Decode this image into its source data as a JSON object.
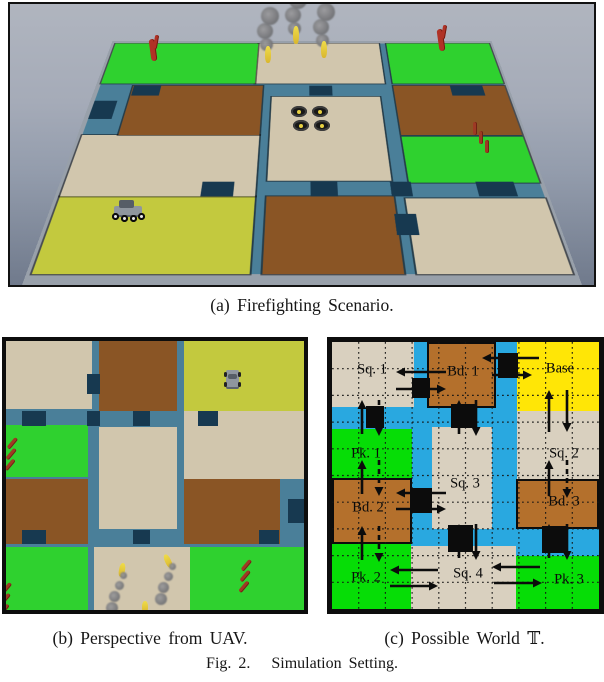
{
  "captions": {
    "a": "(a) Firefighting Scenario.",
    "b": "(b) Perspective from UAV.",
    "c": "(c) Possible World 𝕋.",
    "fig": "Fig. 2.   Simulation Setting."
  },
  "palette": {
    "tan": "#d1c6ad",
    "brown": "#8a5525",
    "green": "#2fd12f",
    "yellow": "#c3c93e",
    "road": "#4a7f99",
    "roadDark": "#173950",
    "groundGray": "#98a0aa",
    "mapBlue": "#29a8e0",
    "mapTan": "#d9d0bf",
    "mapBrown": "#b4702c",
    "mapGreen": "#06dd06",
    "mapYellow": "#ffe606",
    "ink": "#0c0c0c"
  },
  "world": {
    "tiles": [
      {
        "name": "square-1",
        "c": "tan",
        "x": 0,
        "y": 0,
        "w": 28.7,
        "h": 25.2
      },
      {
        "name": "building-1",
        "c": "brown",
        "x": 31.2,
        "y": 0,
        "w": 26.2,
        "h": 26
      },
      {
        "name": "base",
        "c": "yellow",
        "x": 59.7,
        "y": 0,
        "w": 40.3,
        "h": 26
      },
      {
        "name": "park-1",
        "c": "green",
        "x": 0,
        "y": 31.2,
        "w": 27.5,
        "h": 19.3
      },
      {
        "name": "square-2",
        "c": "tan",
        "x": 59.7,
        "y": 26,
        "w": 40.3,
        "h": 25.3
      },
      {
        "name": "square-3",
        "c": "tan",
        "x": 31.2,
        "y": 31.9,
        "w": 26.2,
        "h": 37.9
      },
      {
        "name": "building-2",
        "c": "brown",
        "x": 0,
        "y": 51.3,
        "w": 27.5,
        "h": 24.2
      },
      {
        "name": "building-3",
        "c": "brown",
        "x": 59.7,
        "y": 51.3,
        "w": 32.2,
        "h": 24.2
      },
      {
        "name": "park-2",
        "c": "green",
        "x": 0,
        "y": 76.6,
        "w": 27.5,
        "h": 23.4
      },
      {
        "name": "square-4",
        "c": "tan",
        "x": 29.5,
        "y": 76.6,
        "w": 32.2,
        "h": 23.4
      },
      {
        "name": "park-3",
        "c": "green",
        "x": 61.7,
        "y": 76.6,
        "w": 38.3,
        "h": 23.4
      }
    ],
    "road_patches": [
      {
        "x": 5.4,
        "y": 26.0,
        "w": 8.1,
        "h": 5.6
      },
      {
        "x": 27.2,
        "y": 26.0,
        "w": 4.4,
        "h": 5.6
      },
      {
        "x": 42.6,
        "y": 26.0,
        "w": 5.7,
        "h": 5.6
      },
      {
        "x": 64.4,
        "y": 26.0,
        "w": 6.7,
        "h": 5.6
      },
      {
        "x": 27.2,
        "y": 12.3,
        "w": 4.4,
        "h": 7.4
      },
      {
        "x": 5.4,
        "y": 70.3,
        "w": 8.1,
        "h": 5.2
      },
      {
        "x": 42.6,
        "y": 70.3,
        "w": 5.7,
        "h": 5.2
      },
      {
        "x": 84.9,
        "y": 70.3,
        "w": 6.7,
        "h": 5.2
      },
      {
        "x": 94.6,
        "y": 58.7,
        "w": 5.4,
        "h": 8.9
      }
    ]
  },
  "panel_a": {
    "sprites": [
      {
        "t": "smokeplume",
        "x": 247,
        "y": 6
      },
      {
        "t": "smokeplume",
        "x": 275,
        "y": -10
      },
      {
        "t": "smokeplume",
        "x": 303,
        "y": 2
      },
      {
        "t": "flame",
        "x": 255,
        "y": 42,
        "h": 17,
        "r": 0
      },
      {
        "t": "flame",
        "x": 283,
        "y": 22,
        "h": 18,
        "r": 0
      },
      {
        "t": "flame",
        "x": 311,
        "y": 37,
        "h": 17,
        "r": 0
      },
      {
        "t": "fireflame",
        "x": 140,
        "y": 31
      },
      {
        "t": "fireflame",
        "x": 428,
        "y": 21
      },
      {
        "t": "firesticks",
        "x": 463,
        "y": 118,
        "r": 0
      },
      {
        "t": "drone",
        "x": 281,
        "y": 102
      },
      {
        "t": "rover3d",
        "x": 102,
        "y": 196
      }
    ]
  },
  "panel_b": {
    "sprites": [
      {
        "t": "rovertop",
        "x": 218,
        "y": 29
      },
      {
        "t": "firesticks",
        "x": 9,
        "y": 96,
        "r": 40
      },
      {
        "t": "firesticks",
        "x": 3,
        "y": 241,
        "r": 40
      },
      {
        "t": "firesticks",
        "x": 243,
        "y": 218,
        "r": 40
      },
      {
        "t": "flame",
        "x": 113,
        "y": 222,
        "h": 14,
        "r": 10
      },
      {
        "t": "flame",
        "x": 159,
        "y": 213,
        "h": 14,
        "r": -25
      },
      {
        "t": "flame",
        "x": 136,
        "y": 260,
        "h": 12,
        "r": 0
      },
      {
        "t": "smoketrail",
        "x": 101,
        "y": 231
      },
      {
        "t": "smoketrail",
        "x": 150,
        "y": 222
      }
    ]
  },
  "panel_c": {
    "grid_cell": 26.7,
    "regions": [
      {
        "id": "sq1",
        "label": "Sq. 1",
        "c": "mapTan",
        "x": 0,
        "y": 0,
        "w": 82,
        "h": 65,
        "outlined": false,
        "lx": 40,
        "ly": 28
      },
      {
        "id": "bd1",
        "label": "Bd. 1",
        "c": "mapBrown",
        "x": 95,
        "y": 0,
        "w": 69,
        "h": 66,
        "outlined": true,
        "lx": 131,
        "ly": 30
      },
      {
        "id": "base",
        "label": "Base",
        "c": "mapYellow",
        "x": 185,
        "y": 0,
        "w": 82,
        "h": 69,
        "outlined": false,
        "lx": 228,
        "ly": 27
      },
      {
        "id": "pk1",
        "label": "Pk. 1",
        "c": "mapGreen",
        "x": 0,
        "y": 87,
        "w": 80,
        "h": 49,
        "outlined": false,
        "lx": 34,
        "ly": 112
      },
      {
        "id": "sq2",
        "label": "Sq. 2",
        "c": "mapTan",
        "x": 185,
        "y": 69,
        "w": 82,
        "h": 68,
        "outlined": false,
        "lx": 232,
        "ly": 112
      },
      {
        "id": "sq3",
        "label": "Sq. 3",
        "c": "mapTan",
        "x": 100,
        "y": 85,
        "w": 60,
        "h": 102,
        "outlined": false,
        "lx": 133,
        "ly": 142
      },
      {
        "id": "bd2",
        "label": "Bd. 2",
        "c": "mapBrown",
        "x": 0,
        "y": 136,
        "w": 80,
        "h": 66,
        "outlined": true,
        "lx": 36,
        "ly": 166
      },
      {
        "id": "bd3",
        "label": "Bd. 3",
        "c": "mapBrown",
        "x": 184,
        "y": 137,
        "w": 83,
        "h": 50,
        "outlined": true,
        "lx": 232,
        "ly": 160
      },
      {
        "id": "pk2",
        "label": "Pk. 2",
        "c": "mapGreen",
        "x": 0,
        "y": 202,
        "w": 79,
        "h": 65,
        "outlined": false,
        "lx": 34,
        "ly": 236
      },
      {
        "id": "sq4",
        "label": "Sq. 4",
        "c": "mapTan",
        "x": 79,
        "y": 204,
        "w": 105,
        "h": 63,
        "outlined": false,
        "lx": 136,
        "ly": 232
      },
      {
        "id": "pk3",
        "label": "Pk. 3",
        "c": "mapGreen",
        "x": 184,
        "y": 214,
        "w": 83,
        "h": 53,
        "outlined": false,
        "lx": 237,
        "ly": 238
      }
    ],
    "doors": [
      [
        80,
        36,
        18,
        20
      ],
      [
        34,
        64,
        18,
        22
      ],
      [
        166,
        11,
        20,
        25
      ],
      [
        119,
        62,
        25,
        24
      ],
      [
        78,
        146,
        22,
        25
      ],
      [
        116,
        183,
        25,
        27
      ],
      [
        210,
        184,
        25,
        27
      ]
    ],
    "arrows": [
      [
        114,
        30,
        64,
        30,
        0
      ],
      [
        64,
        47,
        114,
        47,
        0
      ],
      [
        207,
        16,
        150,
        16,
        0
      ],
      [
        160,
        33,
        200,
        33,
        0
      ],
      [
        114,
        151,
        64,
        151,
        0
      ],
      [
        64,
        167,
        114,
        167,
        0
      ],
      [
        106,
        228,
        58,
        228,
        0
      ],
      [
        58,
        244,
        106,
        244,
        0
      ],
      [
        208,
        225,
        160,
        225,
        0
      ],
      [
        162,
        241,
        210,
        241,
        0
      ],
      [
        30,
        92,
        30,
        58,
        0
      ],
      [
        47,
        58,
        47,
        94,
        1
      ],
      [
        30,
        152,
        30,
        118,
        0
      ],
      [
        47,
        118,
        47,
        154,
        1
      ],
      [
        30,
        218,
        30,
        184,
        0
      ],
      [
        47,
        184,
        47,
        220,
        1
      ],
      [
        217,
        90,
        217,
        48,
        0
      ],
      [
        235,
        48,
        235,
        90,
        0
      ],
      [
        217,
        154,
        217,
        118,
        0
      ],
      [
        235,
        118,
        235,
        156,
        1
      ],
      [
        127,
        92,
        127,
        58,
        0
      ],
      [
        144,
        58,
        144,
        94,
        0
      ],
      [
        127,
        216,
        127,
        182,
        0
      ],
      [
        144,
        182,
        144,
        218,
        0
      ],
      [
        217,
        216,
        217,
        182,
        0
      ],
      [
        235,
        182,
        235,
        218,
        0
      ]
    ]
  }
}
